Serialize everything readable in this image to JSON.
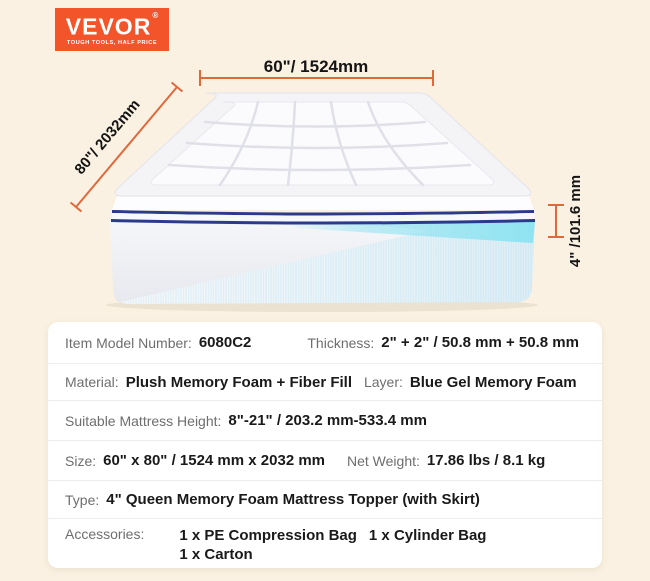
{
  "colors": {
    "background": "#FAF1E2",
    "logo_bg": "#F4542A",
    "dimension_line": "#E0693C",
    "navy_piping": "#2C3A8C",
    "gel_layer": "#8FE4F2",
    "card_bg": "#FFFFFF"
  },
  "logo": {
    "wordmark": "VEVOR",
    "registered": "®",
    "tagline": "TOUGH TOOLS, HALF PRICE"
  },
  "dimensions": {
    "width": "60\"/ 1524mm",
    "depth": "80\"/ 2032mm",
    "height": "4\" /101.6 mm"
  },
  "specs": {
    "rows": [
      {
        "pairs": [
          {
            "label": "Item Model Number:",
            "value": "6080C2"
          },
          {
            "label": "Thickness:",
            "value": "2\" + 2\" / 50.8 mm + 50.8 mm"
          }
        ]
      },
      {
        "pairs": [
          {
            "label": "Material:",
            "value": "Plush Memory Foam + Fiber Fill"
          },
          {
            "label": "Layer:",
            "value": "Blue Gel Memory Foam"
          }
        ]
      },
      {
        "pairs": [
          {
            "label": "Suitable Mattress Height:",
            "value": "8\"-21\" / 203.2 mm-533.4 mm"
          }
        ]
      },
      {
        "pairs": [
          {
            "label": "Size:",
            "value": "60\" x 80\" / 1524 mm x 2032 mm"
          },
          {
            "label": "Net Weight:",
            "value": "17.86 lbs / 8.1 kg"
          }
        ]
      },
      {
        "pairs": [
          {
            "label": "Type:",
            "value": "4\" Queen Memory Foam Mattress Topper (with Skirt)"
          }
        ]
      },
      {
        "pairs": [
          {
            "label": "Accessories:",
            "value_lines": {
              "line1a": "1 x PE Compression Bag",
              "line1b": "1 x Cylinder Bag",
              "line2": "1 x Carton"
            }
          }
        ]
      }
    ]
  }
}
